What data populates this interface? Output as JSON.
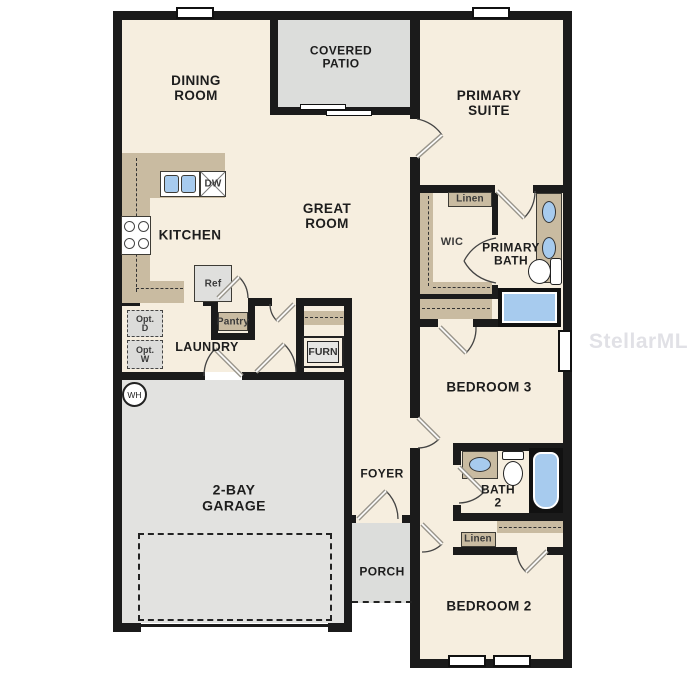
{
  "watermark": "StellarMLS",
  "rooms": {
    "dining": "DINING\nROOM",
    "covered_patio": "COVERED\nPATIO",
    "primary_suite": "PRIMARY\nSUITE",
    "kitchen": "KITCHEN",
    "great_room": "GREAT\nROOM",
    "wic": "WIC",
    "primary_bath": "PRIMARY\nBATH",
    "laundry": "LAUNDRY",
    "garage": "2-BAY\nGARAGE",
    "foyer": "FOYER",
    "bedroom3": "BEDROOM 3",
    "bath2": "BATH\n2",
    "porch": "PORCH",
    "bedroom2": "BEDROOM 2"
  },
  "fixtures": {
    "linen_top": "Linen",
    "linen_bottom": "Linen",
    "pantry": "Pantry",
    "furnace": "FURN",
    "water_heater": "WH",
    "dishwasher": "DW",
    "refrigerator": "Ref",
    "opt_dryer": "Opt.\nD",
    "opt_washer": "Opt.\nW"
  },
  "colors": {
    "wall": "#1b1b1b",
    "floor": "#f6eedf",
    "counter_tan": "#c9bba1",
    "fixture_blue": "#a7cbee",
    "exterior_gray": "#e2e2e0"
  }
}
